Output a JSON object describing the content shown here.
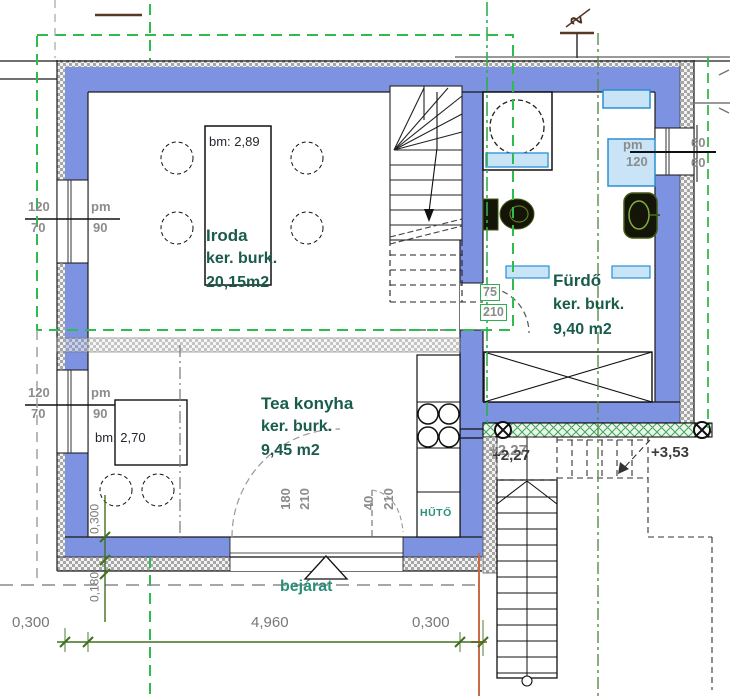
{
  "rooms": {
    "iroda": {
      "bm": "bm: 2,89",
      "name": "Iroda",
      "finish": "ker. burk.",
      "area": "20,15m2"
    },
    "tea_konyha": {
      "bm": "bm: 2,70",
      "name": "Tea konyha",
      "finish": "ker. burk.",
      "area": "9,45 m2"
    },
    "furdo": {
      "name": "Fürdő",
      "finish": "ker. burk.",
      "area": "9,40 m2"
    }
  },
  "openings": {
    "window_left_1": {
      "width": "120",
      "sill": "70",
      "pm_label": "pm",
      "pm_value": "90"
    },
    "window_left_2": {
      "width": "120",
      "sill": "70",
      "pm_label": "pm",
      "pm_value": "90"
    },
    "window_bath": {
      "pm_label": "pm",
      "pm_value": "120",
      "dim_top": "60",
      "dim_bottom": "60"
    },
    "door_bath": {
      "width": "75",
      "height": "210"
    },
    "door_entrance": {
      "width": "180",
      "height": "210"
    },
    "door_entrance_side": {
      "width": "40",
      "height": "210"
    },
    "entrance_label": "bejárat"
  },
  "fixtures": {
    "fridge": "HŰTŐ"
  },
  "levels": {
    "stair_landing": "+2,27",
    "terrace": "+3,53"
  },
  "dimensions": {
    "bottom_left": "0,300",
    "bottom_middle": "4,960",
    "bottom_right": "0,300",
    "wall_thickness": "0,300",
    "insulation": "0,180"
  },
  "marks": {
    "section": "2"
  },
  "colors": {
    "wall_blue": "#7e92e2",
    "window_fill": "#c9e4f6",
    "window_border": "#2a8fd4",
    "axis_green": "#2fbb4d",
    "dim_green": "#3f7020",
    "label_gray": "#8c8c8c",
    "room_text": "#1a5c4c",
    "teal_text": "#2a8f7a",
    "survey_orange": "#c96a48"
  }
}
